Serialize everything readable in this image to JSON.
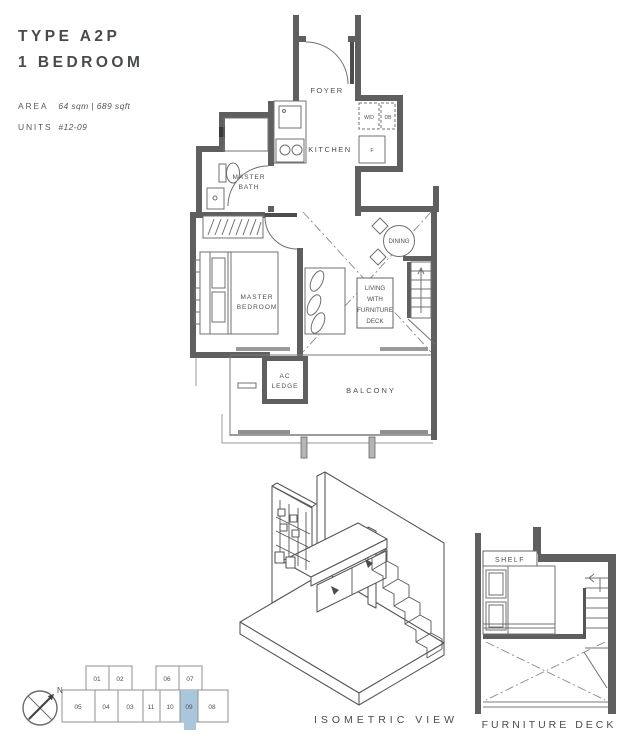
{
  "colors": {
    "wall": "#5f5f5f",
    "line": "#707070",
    "text_dark": "#474b4a",
    "unit_highlight": "#aac6db"
  },
  "header": {
    "type_title": "TYPE A2P",
    "bedroom_title": "1 BEDROOM"
  },
  "meta": {
    "area_label": "AREA",
    "area_value": "64 sqm | 689 sqft",
    "units_label": "UNITS",
    "units_value": "#12-09"
  },
  "plan": {
    "foyer": "FOYER",
    "kitchen": "KITCHEN",
    "washer_dryer": "W/D",
    "db": "DB",
    "fridge": "F",
    "master_bath": [
      "MASTER",
      "BATH"
    ],
    "master_bedroom": [
      "MASTER",
      "BEDROOM"
    ],
    "dining": "DINING",
    "living": [
      "LIVING",
      "WITH",
      "FURNITURE",
      "DECK"
    ],
    "ac_ledge": [
      "AC",
      "LEDGE"
    ],
    "balcony": "BALCONY"
  },
  "isometric": {
    "caption": "ISOMETRIC VIEW"
  },
  "furniture_deck": {
    "caption": "FURNITURE DECK",
    "shelf": "SHELF"
  },
  "key_plan": {
    "top_units": [
      "01",
      "02",
      "06",
      "07"
    ],
    "bottom_units": [
      "05",
      "04",
      "03",
      "11",
      "10",
      "09",
      "08"
    ],
    "highlighted_unit": "09"
  },
  "compass": {
    "north": "N"
  }
}
